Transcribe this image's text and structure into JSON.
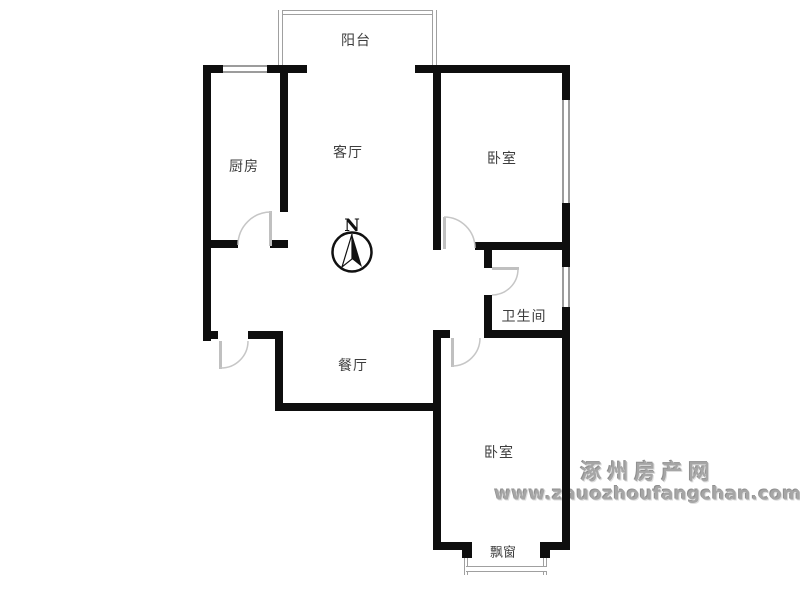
{
  "rooms": {
    "balcony": {
      "label": "阳台"
    },
    "kitchen": {
      "label": "厨房"
    },
    "living_room": {
      "label": "客厅"
    },
    "bedroom_top": {
      "label": "卧室"
    },
    "bathroom": {
      "label": "卫生间"
    },
    "dining_room": {
      "label": "餐厅"
    },
    "bedroom_bottom": {
      "label": "卧室"
    },
    "bay_window": {
      "label": "飘窗"
    }
  },
  "compass": {
    "north_label": "N"
  },
  "watermark": {
    "site_name": "涿州房产网",
    "site_url": "www.zhuozhoufangchan.com"
  },
  "colors": {
    "wall": "#0e0e0e",
    "window_line": "#9c9c9c",
    "door_line": "#c0c0c0",
    "label_text": "#3d3d3d",
    "watermark_text": "#a6a6a6"
  }
}
